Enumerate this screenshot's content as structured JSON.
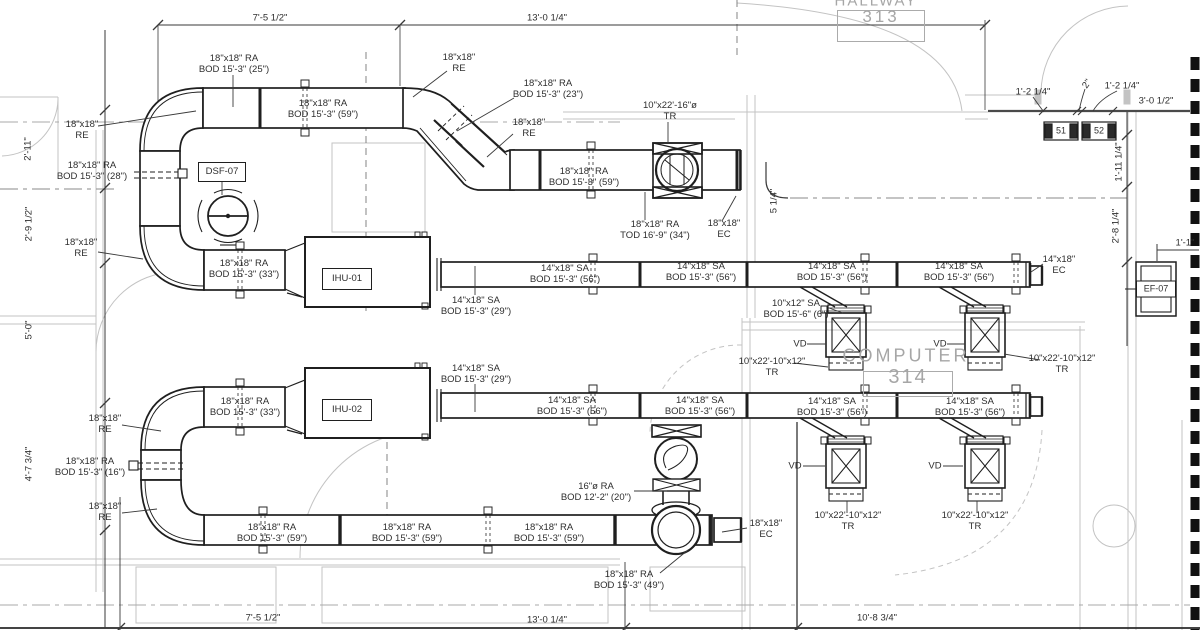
{
  "drawing_type": "HVAC mechanical duct plan",
  "rooms": {
    "hallway": {
      "name": "HALLWAY",
      "number": "313"
    },
    "computer": {
      "name": "COMPUTER",
      "number": "314"
    }
  },
  "equipment": {
    "dsf": "DSF-07",
    "ihu1": "IHU-01",
    "ihu2": "IHU-02",
    "ef": "EF-07",
    "diffuser1": "51",
    "diffuser2": "52"
  },
  "colors": {
    "line": "#1f1f1f",
    "text": "#2e2e2e",
    "architecture": "#c3c3c3",
    "room_text": "#a6a6a6"
  },
  "labels": [
    {
      "n": "dim-top-left",
      "x": 270,
      "y": 18,
      "t": [
        "7'-5 1/2\""
      ]
    },
    {
      "n": "dim-top-mid",
      "x": 547,
      "y": 18,
      "t": [
        "13'-0 1/4\""
      ]
    },
    {
      "n": "dim-diffuser-left",
      "x": 1033,
      "y": 92,
      "t": [
        "1'-2 1/4\""
      ]
    },
    {
      "n": "dim-diffuser-gap",
      "x": 1087,
      "y": 84,
      "t": [
        "2\""
      ],
      "r": -55
    },
    {
      "n": "dim-diffuser-right",
      "x": 1122,
      "y": 86,
      "t": [
        "1'-2 1/4\""
      ]
    },
    {
      "n": "dim-wall-right",
      "x": 1156,
      "y": 101,
      "t": [
        "3'-0 1/2\""
      ]
    },
    {
      "n": "dim-right-upper",
      "x": 1119,
      "y": 162,
      "t": [
        "1'-11 1/4\""
      ],
      "r": -90
    },
    {
      "n": "dim-right-lower",
      "x": 1116,
      "y": 226,
      "t": [
        "2'-8 1/4\""
      ],
      "r": -90
    },
    {
      "n": "dim-ef",
      "x": 1185,
      "y": 243,
      "t": [
        "1'-1\""
      ]
    },
    {
      "n": "dim-left-1",
      "x": 28,
      "y": 149,
      "t": [
        "2'-11\""
      ],
      "r": -90
    },
    {
      "n": "dim-left-2",
      "x": 29,
      "y": 224,
      "t": [
        "2'-9 1/2\""
      ],
      "r": -90
    },
    {
      "n": "dim-left-3",
      "x": 29,
      "y": 330,
      "t": [
        "5'-0\""
      ],
      "r": -90
    },
    {
      "n": "dim-left-4",
      "x": 29,
      "y": 464,
      "t": [
        "4'-7 3/4\""
      ],
      "r": -90
    },
    {
      "n": "dim-riser-offset",
      "x": 774,
      "y": 201,
      "t": [
        "5 1/4\""
      ],
      "r": -90
    },
    {
      "n": "dim-bot-left",
      "x": 263,
      "y": 618,
      "t": [
        "7'-5 1/2\""
      ]
    },
    {
      "n": "dim-bot-mid",
      "x": 547,
      "y": 620,
      "t": [
        "13'-0 1/4\""
      ]
    },
    {
      "n": "dim-bot-right",
      "x": 877,
      "y": 618,
      "t": [
        "10'-8 3/4\""
      ]
    },
    {
      "n": "ra-25",
      "x": 234,
      "y": 64,
      "t": [
        "18\"x18\" RA",
        "BOD 15'-3\" (25\")"
      ]
    },
    {
      "n": "re-top-left",
      "x": 82,
      "y": 130,
      "t": [
        "18\"x18\"",
        "RE"
      ]
    },
    {
      "n": "ra-59-top",
      "x": 323,
      "y": 109,
      "t": [
        "18\"x18\" RA",
        "BOD 15'-3\" (59\")"
      ]
    },
    {
      "n": "re-top-mid",
      "x": 459,
      "y": 63,
      "t": [
        "18\"x18\"",
        "RE"
      ]
    },
    {
      "n": "ra-23",
      "x": 548,
      "y": 89,
      "t": [
        "18\"x18\" RA",
        "BOD 15'-3\" (23\")"
      ]
    },
    {
      "n": "re-mid",
      "x": 529,
      "y": 128,
      "t": [
        "18\"x18\"",
        "RE"
      ]
    },
    {
      "n": "tr-16",
      "x": 670,
      "y": 111,
      "t": [
        "10\"x22'-16\"ø",
        "TR"
      ]
    },
    {
      "n": "ra-59-mid",
      "x": 584,
      "y": 177,
      "t": [
        "18\"x18\" RA",
        "BOD 15'-3\" (59\")"
      ]
    },
    {
      "n": "ra-tod-34",
      "x": 655,
      "y": 230,
      "t": [
        "18\"x18\" RA",
        "TOD 16'-9\" (34\")"
      ]
    },
    {
      "n": "ec-top",
      "x": 724,
      "y": 229,
      "t": [
        "18\"x18\"",
        "EC"
      ]
    },
    {
      "n": "ra-28",
      "x": 92,
      "y": 171,
      "t": [
        "18\"x18\" RA",
        "BOD 15'-3\" (28\")"
      ]
    },
    {
      "n": "re-left-2",
      "x": 81,
      "y": 248,
      "t": [
        "18\"x18\"",
        "RE"
      ]
    },
    {
      "n": "ra-33-top",
      "x": 244,
      "y": 269,
      "t": [
        "18\"x18\" RA",
        "BOD 15'-3\" (33\")"
      ]
    },
    {
      "n": "sa-29-r1",
      "x": 476,
      "y": 306,
      "t": [
        "14\"x18\" SA",
        "BOD 15'-3\" (29\")"
      ]
    },
    {
      "n": "sa-56-r1a",
      "x": 565,
      "y": 274,
      "t": [
        "14\"x18\" SA",
        "BOD 15'-3\" (56\")"
      ]
    },
    {
      "n": "sa-56-r1b",
      "x": 701,
      "y": 272,
      "t": [
        "14\"x18\" SA",
        "BOD 15'-3\" (56\")"
      ]
    },
    {
      "n": "sa-56-r1c",
      "x": 832,
      "y": 272,
      "t": [
        "14\"x18\" SA",
        "BOD 15'-3\" (56\")"
      ]
    },
    {
      "n": "sa-56-r1d",
      "x": 959,
      "y": 272,
      "t": [
        "14\"x18\" SA",
        "BOD 15'-3\" (56\")"
      ]
    },
    {
      "n": "ec-r1",
      "x": 1059,
      "y": 265,
      "t": [
        "14\"x18\"",
        "EC"
      ]
    },
    {
      "n": "sa-10x12",
      "x": 796,
      "y": 309,
      "t": [
        "10\"x12\" SA",
        "BOD 15'-6\" (6\")"
      ]
    },
    {
      "n": "vd-r1-left",
      "x": 800,
      "y": 344,
      "t": [
        "VD"
      ]
    },
    {
      "n": "vd-r1-right",
      "x": 940,
      "y": 344,
      "t": [
        "VD"
      ]
    },
    {
      "n": "tr-r1-left",
      "x": 772,
      "y": 367,
      "t": [
        "10\"x22'-10\"x12\"",
        "TR"
      ]
    },
    {
      "n": "tr-r1-right",
      "x": 1062,
      "y": 364,
      "t": [
        "10\"x22'-10\"x12\"",
        "TR"
      ]
    },
    {
      "n": "sa-29-r2",
      "x": 476,
      "y": 374,
      "t": [
        "14\"x18\" SA",
        "BOD 15'-3\" (29\")"
      ]
    },
    {
      "n": "sa-56-r2a",
      "x": 572,
      "y": 406,
      "t": [
        "14\"x18\" SA",
        "BOD 15'-3\" (56\")"
      ]
    },
    {
      "n": "sa-56-r2b",
      "x": 700,
      "y": 406,
      "t": [
        "14\"x18\" SA",
        "BOD 15'-3\" (56\")"
      ]
    },
    {
      "n": "sa-56-r2c",
      "x": 832,
      "y": 407,
      "t": [
        "14\"x18\" SA",
        "BOD 15'-3\" (56\")"
      ]
    },
    {
      "n": "sa-56-r2d",
      "x": 970,
      "y": 407,
      "t": [
        "14\"x18\" SA",
        "BOD 15'-3\" (56\")"
      ]
    },
    {
      "n": "vd-r2-left",
      "x": 795,
      "y": 466,
      "t": [
        "VD"
      ]
    },
    {
      "n": "vd-r2-right",
      "x": 935,
      "y": 466,
      "t": [
        "VD"
      ]
    },
    {
      "n": "tr-r2-left",
      "x": 848,
      "y": 521,
      "t": [
        "10\"x22'-10\"x12\"",
        "TR"
      ]
    },
    {
      "n": "tr-r2-right",
      "x": 975,
      "y": 521,
      "t": [
        "10\"x22'-10\"x12\"",
        "TR"
      ]
    },
    {
      "n": "re-bot-1",
      "x": 105,
      "y": 424,
      "t": [
        "18\"x18\"",
        "RE"
      ]
    },
    {
      "n": "ra-16",
      "x": 90,
      "y": 467,
      "t": [
        "18\"x18\" RA",
        "BOD 15'-3\" (16\")"
      ]
    },
    {
      "n": "re-bot-2",
      "x": 105,
      "y": 512,
      "t": [
        "18\"x18\"",
        "RE"
      ]
    },
    {
      "n": "ra-33-bot",
      "x": 245,
      "y": 407,
      "t": [
        "18\"x18\" RA",
        "BOD 15'-3\" (33\")"
      ]
    },
    {
      "n": "ra-16dia",
      "x": 596,
      "y": 492,
      "t": [
        "16\"ø RA",
        "BOD 12'-2\" (20\")"
      ]
    },
    {
      "n": "ra-59-b1",
      "x": 272,
      "y": 533,
      "t": [
        "18\"x18\" RA",
        "BOD 15'-3\" (59\")"
      ]
    },
    {
      "n": "ra-59-b2",
      "x": 407,
      "y": 533,
      "t": [
        "18\"x18\" RA",
        "BOD 15'-3\" (59\")"
      ]
    },
    {
      "n": "ra-59-b3",
      "x": 549,
      "y": 533,
      "t": [
        "18\"x18\" RA",
        "BOD 15'-3\" (59\")"
      ]
    },
    {
      "n": "ec-bot",
      "x": 766,
      "y": 529,
      "t": [
        "18\"x18\"",
        "EC"
      ]
    },
    {
      "n": "ra-49",
      "x": 629,
      "y": 580,
      "t": [
        "18\"x18\" RA",
        "BOD 15'-3\" (49\")"
      ]
    }
  ]
}
